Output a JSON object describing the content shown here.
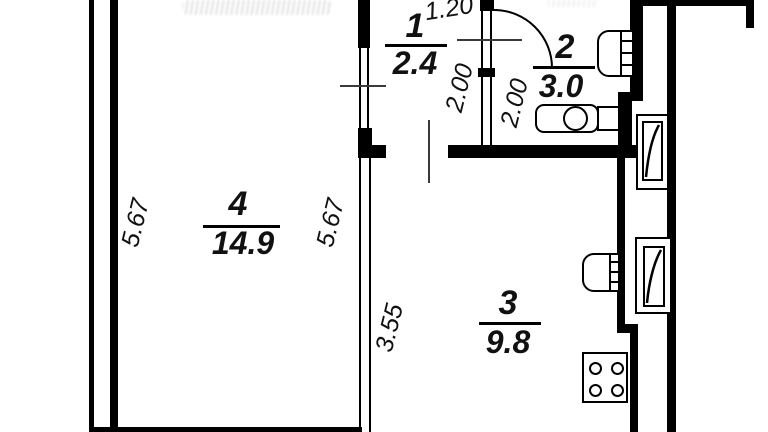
{
  "title": "Apartment floor plan",
  "colors": {
    "wall": "#000000",
    "bg": "#ffffff",
    "ink": "#111111"
  },
  "rooms": {
    "r1": {
      "number": "1",
      "area": "2.4"
    },
    "r2": {
      "number": "2",
      "area": "3.0"
    },
    "r3": {
      "number": "3",
      "area": "9.8"
    },
    "r4": {
      "number": "4",
      "area": "14.9"
    }
  },
  "dims": {
    "entry_width": "1.20",
    "r1_depth": "2.00",
    "r2_depth": "2.00",
    "left_height": "5.67",
    "r4_height": "5.67",
    "r3_height": "3.55"
  },
  "fixtures": [
    "washbasin",
    "toilet",
    "kitchen-sink",
    "stove",
    "ventilation-shaft-upper",
    "ventilation-shaft-lower",
    "door-swing-arc"
  ]
}
